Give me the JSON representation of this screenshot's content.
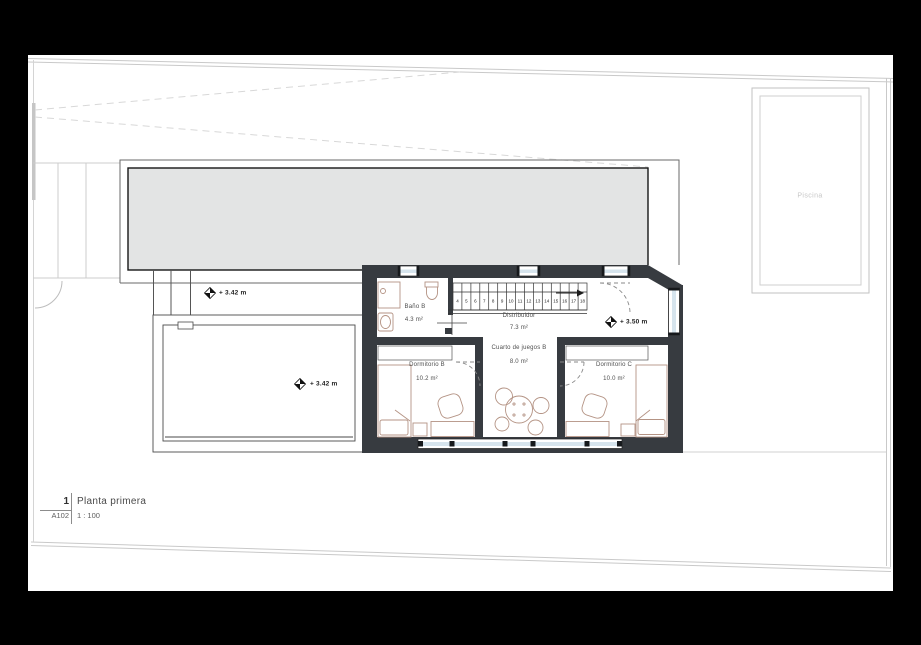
{
  "title_block": {
    "detail_number": "1",
    "sheet_code": "A102",
    "view_title": "Planta primera",
    "scale": "1 : 100"
  },
  "rooms": {
    "bano": {
      "name": "Baño B",
      "area": "4.3 m²"
    },
    "distribuidor": {
      "name": "Distribuidor",
      "area": "7.3 m²"
    },
    "juegos": {
      "name": "Cuarto de juegos B",
      "area": "8.0 m²"
    },
    "dorm_b": {
      "name": "Dormitorio B",
      "area": "10.2 m²"
    },
    "dorm_c": {
      "name": "Dormitorio C",
      "area": "10.0 m²"
    }
  },
  "pool": {
    "name": "Piscina"
  },
  "levels": {
    "roof_terrace": "+ 3.42 m",
    "lower_terrace": "+ 3.42 m",
    "interior": "+ 3.50 m"
  },
  "stairs": {
    "treads": [
      "4",
      "5",
      "6",
      "7",
      "8",
      "9",
      "10",
      "11",
      "12",
      "13",
      "14",
      "15",
      "16",
      "17",
      "18"
    ]
  },
  "colors": {
    "wall": "#373b40",
    "glazing": "#d6e4ed",
    "roof_fill": "#e3e4e4",
    "furniture_line": "#b49384",
    "site_line": "#c9c9c9"
  }
}
